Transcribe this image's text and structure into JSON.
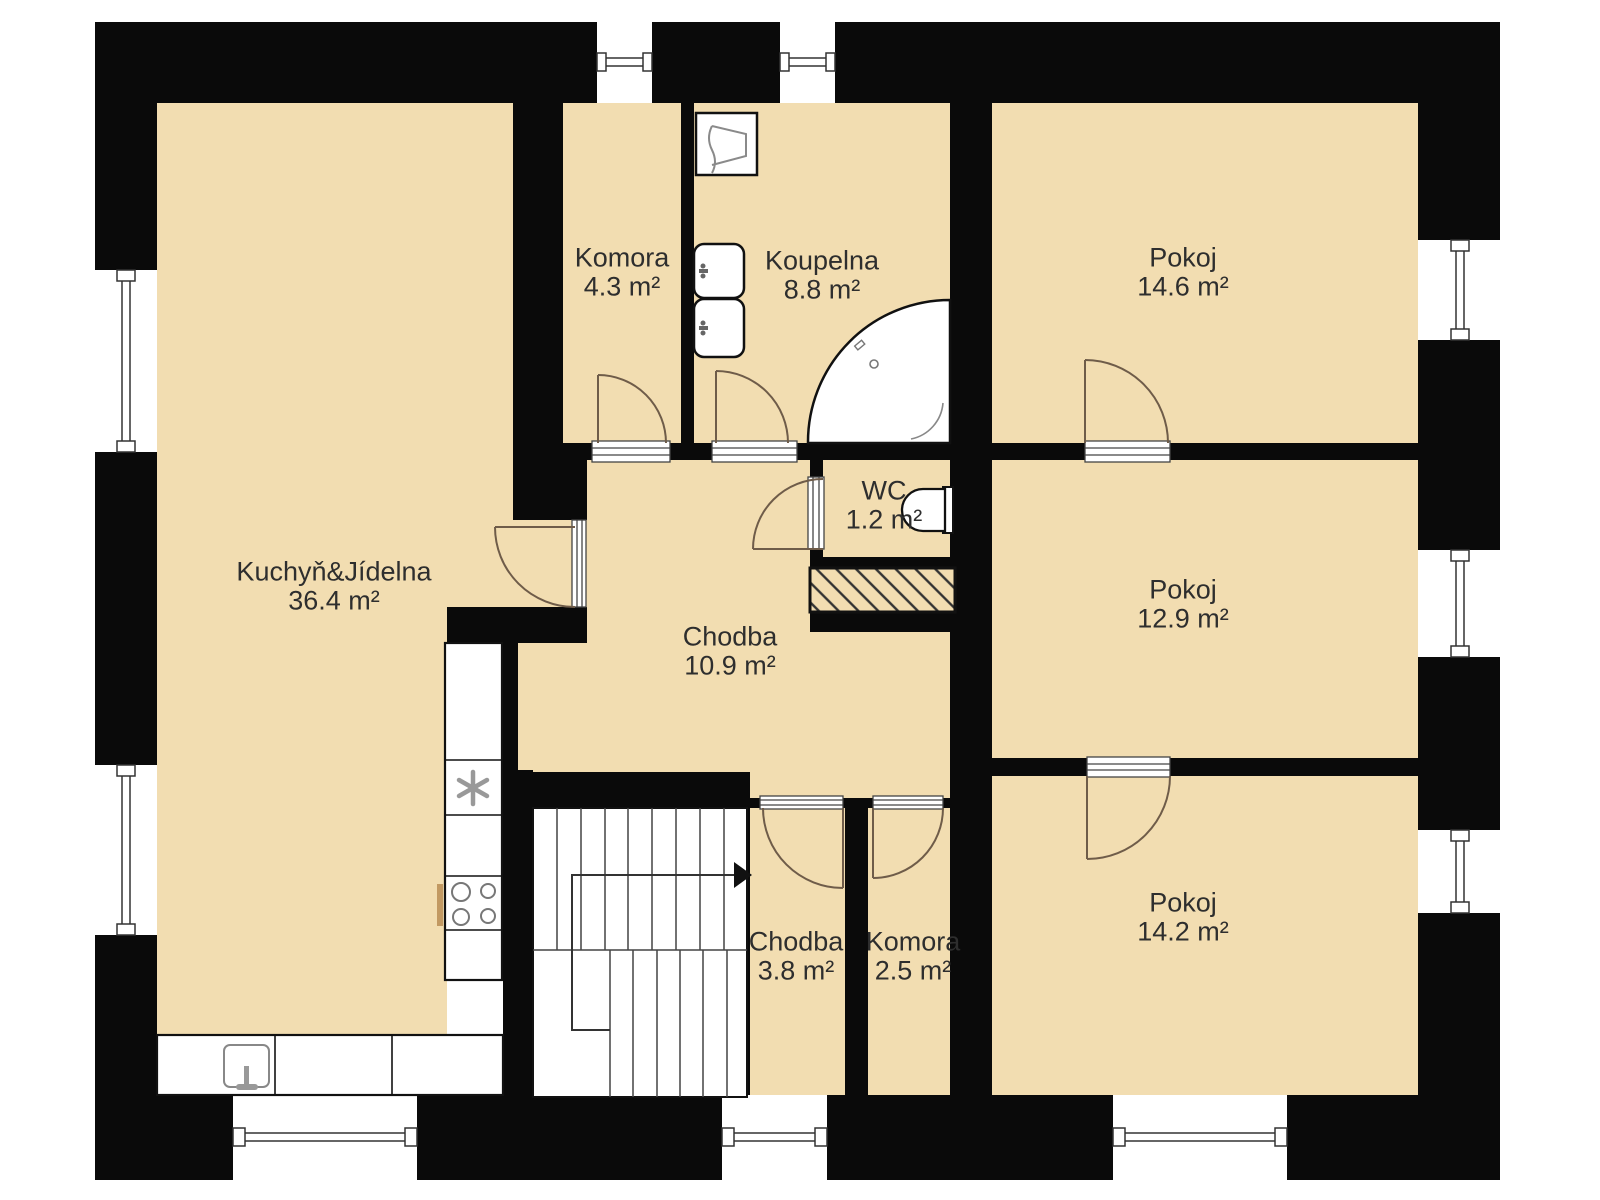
{
  "plan": {
    "title": "Floor plan",
    "colors": {
      "floor": "#f2ddb1",
      "wall": "#0a0a0a",
      "fixture_outline": "#111111",
      "hatch_line": "#333333",
      "label_text": "#2e2e2e",
      "door_arc": "#6f5c49"
    },
    "rooms": [
      {
        "id": "kitchen",
        "name": "Kuchyň&Jídelna",
        "area": "36.4 m²"
      },
      {
        "id": "komora-top",
        "name": "Komora",
        "area": "4.3 m²"
      },
      {
        "id": "koupelna",
        "name": "Koupelna",
        "area": "8.8 m²"
      },
      {
        "id": "pokoj-top",
        "name": "Pokoj",
        "area": "14.6 m²"
      },
      {
        "id": "wc",
        "name": "WC",
        "area": "1.2 m²"
      },
      {
        "id": "chodba-main",
        "name": "Chodba",
        "area": "10.9 m²"
      },
      {
        "id": "pokoj-middle",
        "name": "Pokoj",
        "area": "12.9 m²"
      },
      {
        "id": "chodba-lower",
        "name": "Chodba",
        "area": "3.8 m²"
      },
      {
        "id": "komora-lower",
        "name": "Komora",
        "area": "2.5 m²"
      },
      {
        "id": "pokoj-bottom",
        "name": "Pokoj",
        "area": "14.2 m²"
      }
    ],
    "fixtures": [
      "washing-machine",
      "bathroom-sink",
      "bathroom-sink",
      "corner-bathtub",
      "toilet",
      "ventilation-shaft",
      "staircase",
      "fridge-freezer",
      "stove-4-burners",
      "kitchen-counter",
      "kitchen-sink"
    ],
    "staircase": {
      "direction_arrow": "right"
    },
    "window_count": 9,
    "door_count": 8
  }
}
